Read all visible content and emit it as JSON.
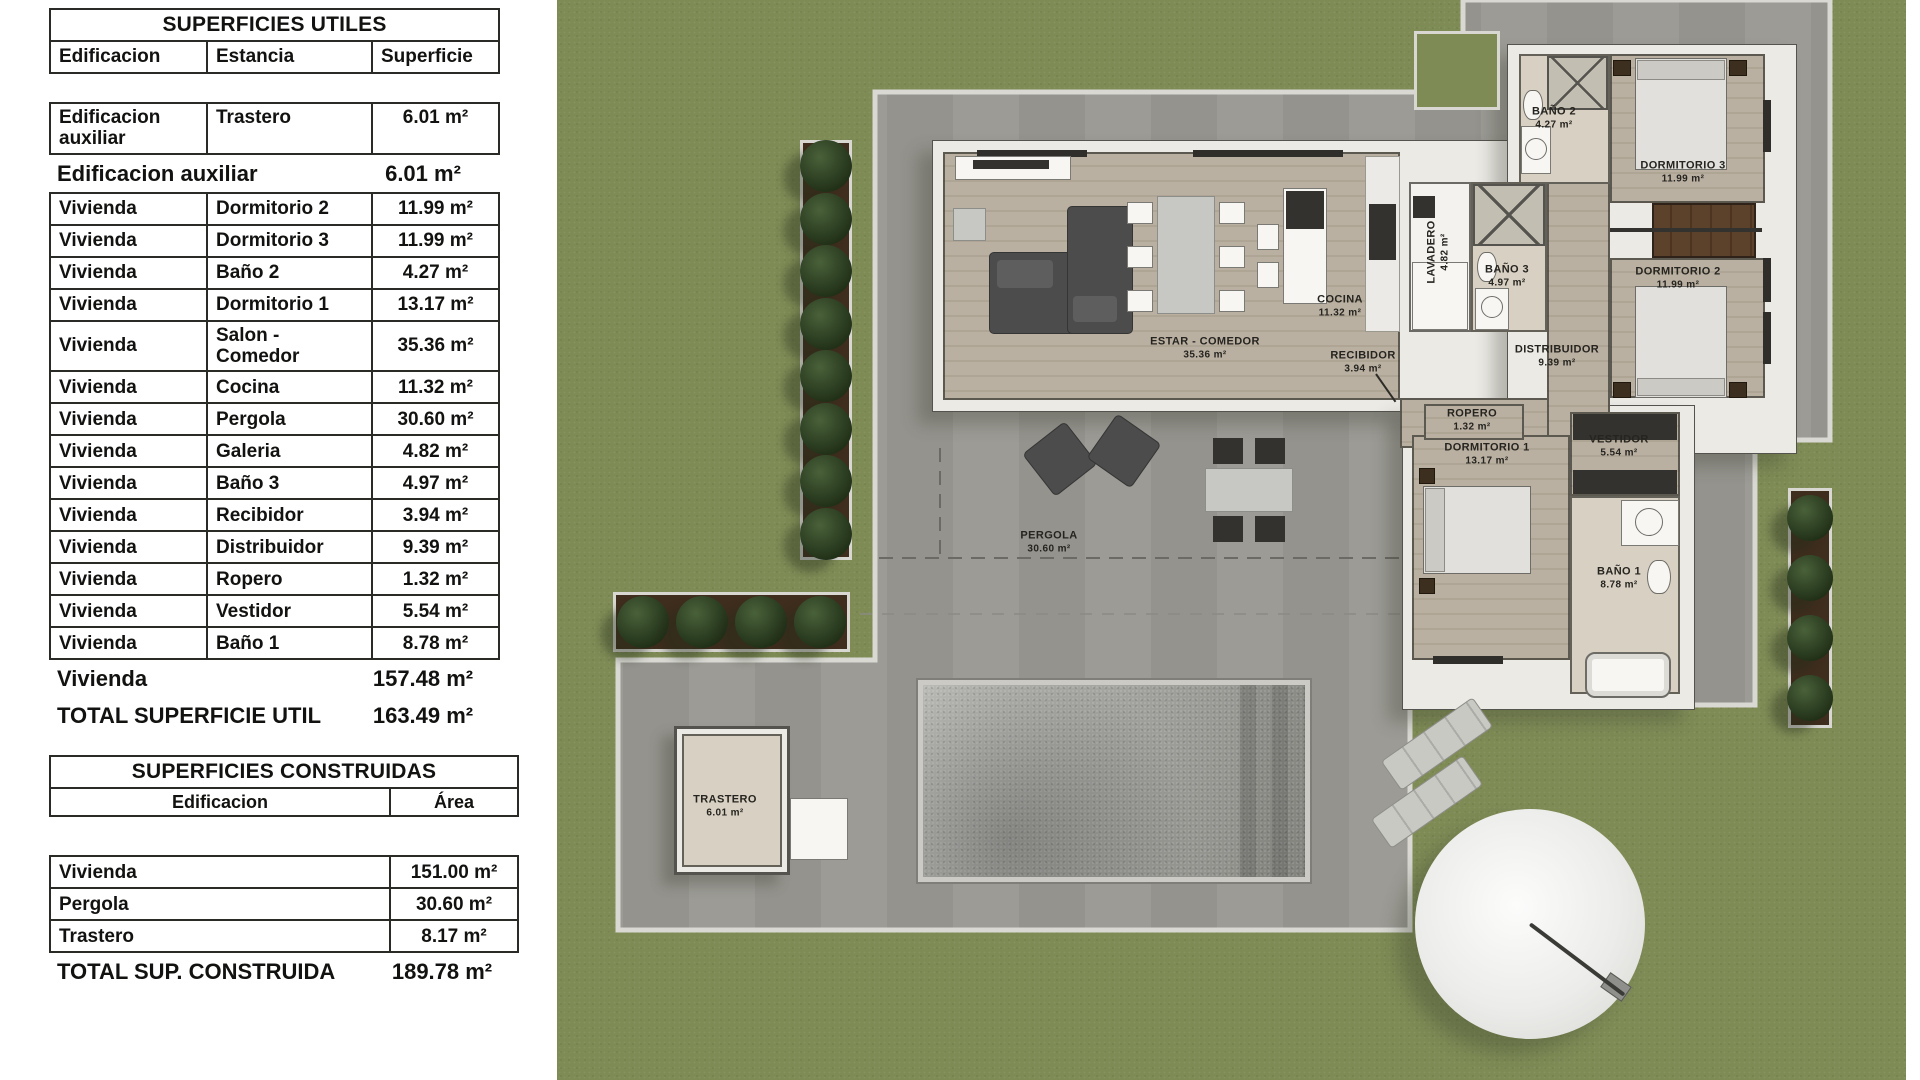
{
  "tables": {
    "utiles": {
      "title": "SUPERFICIES UTILES",
      "headers": [
        "Edificacion",
        "Estancia",
        "Superficie"
      ],
      "aux_row": {
        "edificacion": "Edificacion auxiliar",
        "estancia": "Trastero",
        "superficie": "6.01 m²"
      },
      "aux_subtotal": {
        "label": "Edificacion auxiliar",
        "value": "6.01 m²"
      },
      "rows": [
        {
          "edificacion": "Vivienda",
          "estancia": "Dormitorio 2",
          "superficie": "11.99 m²"
        },
        {
          "edificacion": "Vivienda",
          "estancia": "Dormitorio 3",
          "superficie": "11.99 m²"
        },
        {
          "edificacion": "Vivienda",
          "estancia": "Baño 2",
          "superficie": "4.27 m²"
        },
        {
          "edificacion": "Vivienda",
          "estancia": "Dormitorio 1",
          "superficie": "13.17 m²"
        },
        {
          "edificacion": "Vivienda",
          "estancia": "Salon  - Comedor",
          "superficie": "35.36 m²"
        },
        {
          "edificacion": "Vivienda",
          "estancia": "Cocina",
          "superficie": "11.32 m²"
        },
        {
          "edificacion": "Vivienda",
          "estancia": "Pergola",
          "superficie": "30.60 m²"
        },
        {
          "edificacion": "Vivienda",
          "estancia": "Galeria",
          "superficie": "4.82 m²"
        },
        {
          "edificacion": "Vivienda",
          "estancia": "Baño 3",
          "superficie": "4.97 m²"
        },
        {
          "edificacion": "Vivienda",
          "estancia": "Recibidor",
          "superficie": "3.94 m²"
        },
        {
          "edificacion": "Vivienda",
          "estancia": "Distribuidor",
          "superficie": "9.39 m²"
        },
        {
          "edificacion": "Vivienda",
          "estancia": "Ropero",
          "superficie": "1.32 m²"
        },
        {
          "edificacion": "Vivienda",
          "estancia": "Vestidor",
          "superficie": "5.54 m²"
        },
        {
          "edificacion": "Vivienda",
          "estancia": "Baño 1",
          "superficie": "8.78 m²"
        }
      ],
      "vivienda_subtotal": {
        "label": "Vivienda",
        "value": "157.48 m²"
      },
      "total": {
        "label": "TOTAL SUPERFICIE UTIL",
        "value": "163.49 m²"
      }
    },
    "construidas": {
      "title": "SUPERFICIES CONSTRUIDAS",
      "headers": [
        "Edificacion",
        "Área"
      ],
      "rows": [
        {
          "edificacion": "Vivienda",
          "area": "151.00 m²"
        },
        {
          "edificacion": "Pergola",
          "area": "30.60 m²"
        },
        {
          "edificacion": "Trastero",
          "area": "8.17 m²"
        }
      ],
      "total": {
        "label": "TOTAL SUP. CONSTRUIDA",
        "value": "189.78 m²"
      }
    }
  },
  "plan": {
    "room_labels": [
      {
        "name": "estar-comedor",
        "text": "ESTAR - COMEDOR",
        "area": "35.36 m²",
        "x": 648,
        "y": 348
      },
      {
        "name": "cocina",
        "text": "COCINA",
        "area": "11.32 m²",
        "x": 783,
        "y": 306
      },
      {
        "name": "recibidor",
        "text": "RECIBIDOR",
        "area": "3.94 m²",
        "x": 806,
        "y": 362
      },
      {
        "name": "lavadero",
        "text": "LAVADERO",
        "area": "4.82 m²",
        "x": 881,
        "y": 252,
        "vertical": true
      },
      {
        "name": "bano-3",
        "text": "BAÑO 3",
        "area": "4.97 m²",
        "x": 950,
        "y": 276
      },
      {
        "name": "bano-2",
        "text": "BAÑO 2",
        "area": "4.27 m²",
        "x": 997,
        "y": 118
      },
      {
        "name": "dormitorio-3",
        "text": "DORMITORIO 3",
        "area": "11.99 m²",
        "x": 1126,
        "y": 172
      },
      {
        "name": "dormitorio-2",
        "text": "DORMITORIO 2",
        "area": "11.99 m²",
        "x": 1121,
        "y": 278
      },
      {
        "name": "distribuidor",
        "text": "DISTRIBUIDOR",
        "area": "9.39 m²",
        "x": 1000,
        "y": 356
      },
      {
        "name": "ropero",
        "text": "ROPERO",
        "area": "1.32 m²",
        "x": 915,
        "y": 420
      },
      {
        "name": "dormitorio-1",
        "text": "DORMITORIO 1",
        "area": "13.17 m²",
        "x": 930,
        "y": 454
      },
      {
        "name": "vestidor",
        "text": "VESTIDOR",
        "area": "5.54 m²",
        "x": 1062,
        "y": 446
      },
      {
        "name": "bano-1",
        "text": "BAÑO 1",
        "area": "8.78 m²",
        "x": 1062,
        "y": 578
      },
      {
        "name": "pergola",
        "text": "PERGOLA",
        "area": "30.60 m²",
        "x": 492,
        "y": 542
      },
      {
        "name": "trastero",
        "text": "TRASTERO",
        "area": "6.01 m²",
        "x": 168,
        "y": 806
      }
    ],
    "colors": {
      "grass": "#7e8b55",
      "terrace": "#9c9b95",
      "terrace_stripe": "#94938d",
      "curb": "#d9d8d3",
      "wood": "#b9b0a2",
      "tile": "#d7d0c3",
      "wall": "#eceae5",
      "wardrobe_brown": "#5c422a",
      "pool_light": "#bcbcb8",
      "pool_dark": "#8a8a85",
      "bush_green": "#2e4220",
      "label_ink": "#26241f"
    }
  }
}
